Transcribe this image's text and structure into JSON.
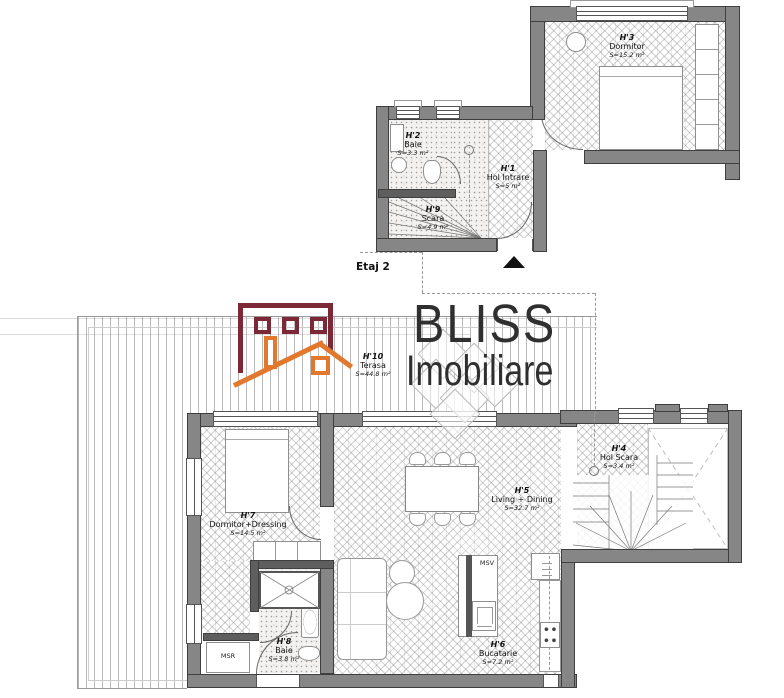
{
  "brand": {
    "name_top": "BLISS",
    "name_bottom": "Imobiliare"
  },
  "floor_label": "Etaj 2",
  "rooms": {
    "h1": {
      "code": "H'1",
      "name": "Hol Intrare",
      "area": "S=5 m²"
    },
    "h2": {
      "code": "H'2",
      "name": "Baie",
      "area": "S=3.3 m²"
    },
    "h3": {
      "code": "H'3",
      "name": "Dormitor",
      "area": "S=15.2 m²"
    },
    "h4": {
      "code": "H'4",
      "name": "Hol Scara",
      "area": "S=3.4 m²"
    },
    "h5": {
      "code": "H'5",
      "name": "Living + Dining",
      "area": "S=32.7 m²"
    },
    "h6": {
      "code": "H'6",
      "name": "Bucatarie",
      "area": "S=7.2 m²"
    },
    "h7": {
      "code": "H'7",
      "name": "Dormitor+Dressing",
      "area": "S=14.5 m²"
    },
    "h8": {
      "code": "H'8",
      "name": "Baie",
      "area": "S=3.8 m²"
    },
    "h9": {
      "code": "H'9",
      "name": "Scara",
      "area": "S=4.9 m²"
    },
    "h10": {
      "code": "H'10",
      "name": "Terasa",
      "area": "S=44.8 m²"
    }
  },
  "appliances": {
    "washing_machine_label": "MSR",
    "dishwasher_label": "MSV"
  },
  "colors": {
    "wall_gray": "#868686",
    "logo_maroon": "#7d2836",
    "logo_orange": "#e2772e",
    "logo_text": "#2f2f2f",
    "label_text": "#111111"
  }
}
